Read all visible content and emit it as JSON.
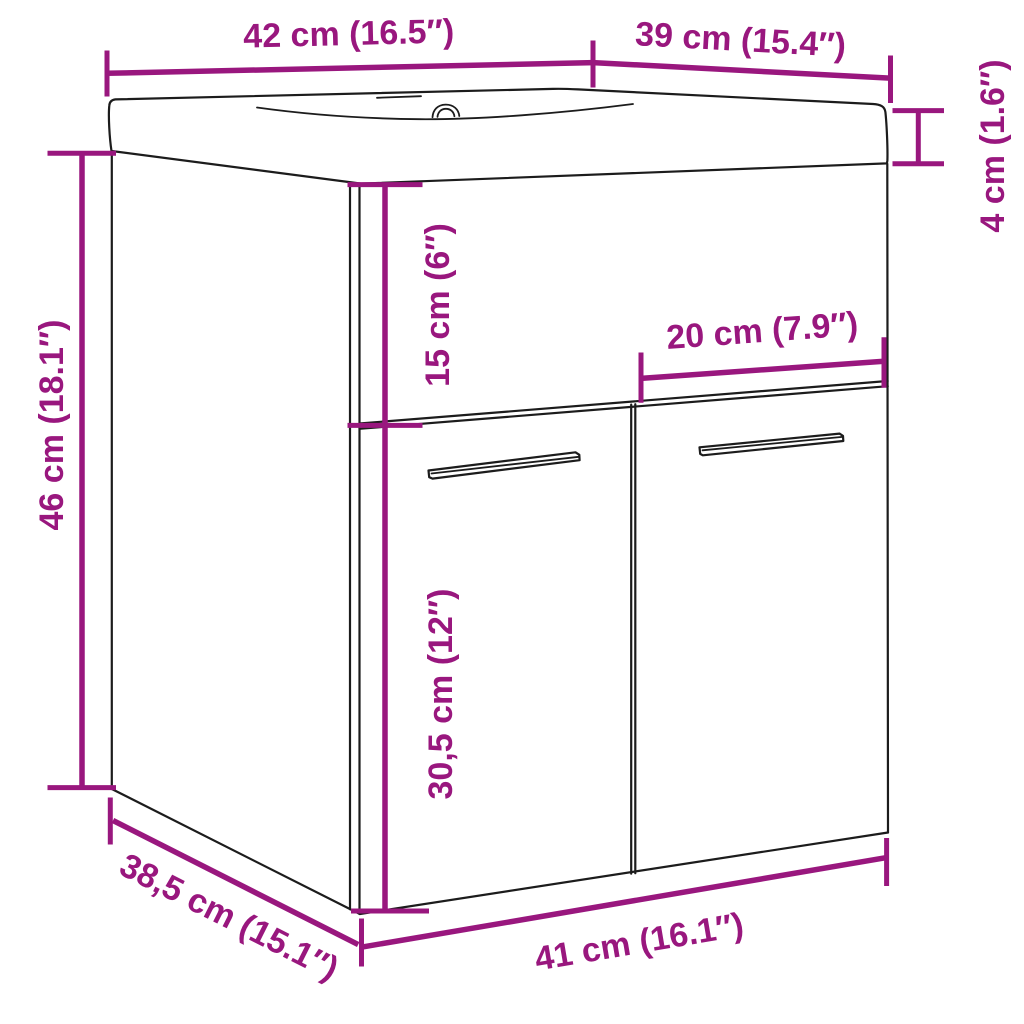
{
  "figure": {
    "accent_color": "#99177E",
    "outline_color": "#1C1C1C",
    "background_color": "#FFFFFF",
    "labels": {
      "basin_width": "42 cm (16.5″)",
      "basin_depth": "39 cm (15.4″)",
      "basin_height": "4 cm (1.6″)",
      "upper_panel_height": "15 cm (6″)",
      "door_width": "20 cm (7.9″)",
      "cabinet_height": "46 cm (18.1″)",
      "door_height": "30,5 cm (12″)",
      "cabinet_depth": "38,5 cm (15.1″)",
      "cabinet_width": "41 cm (16.1″)"
    }
  }
}
